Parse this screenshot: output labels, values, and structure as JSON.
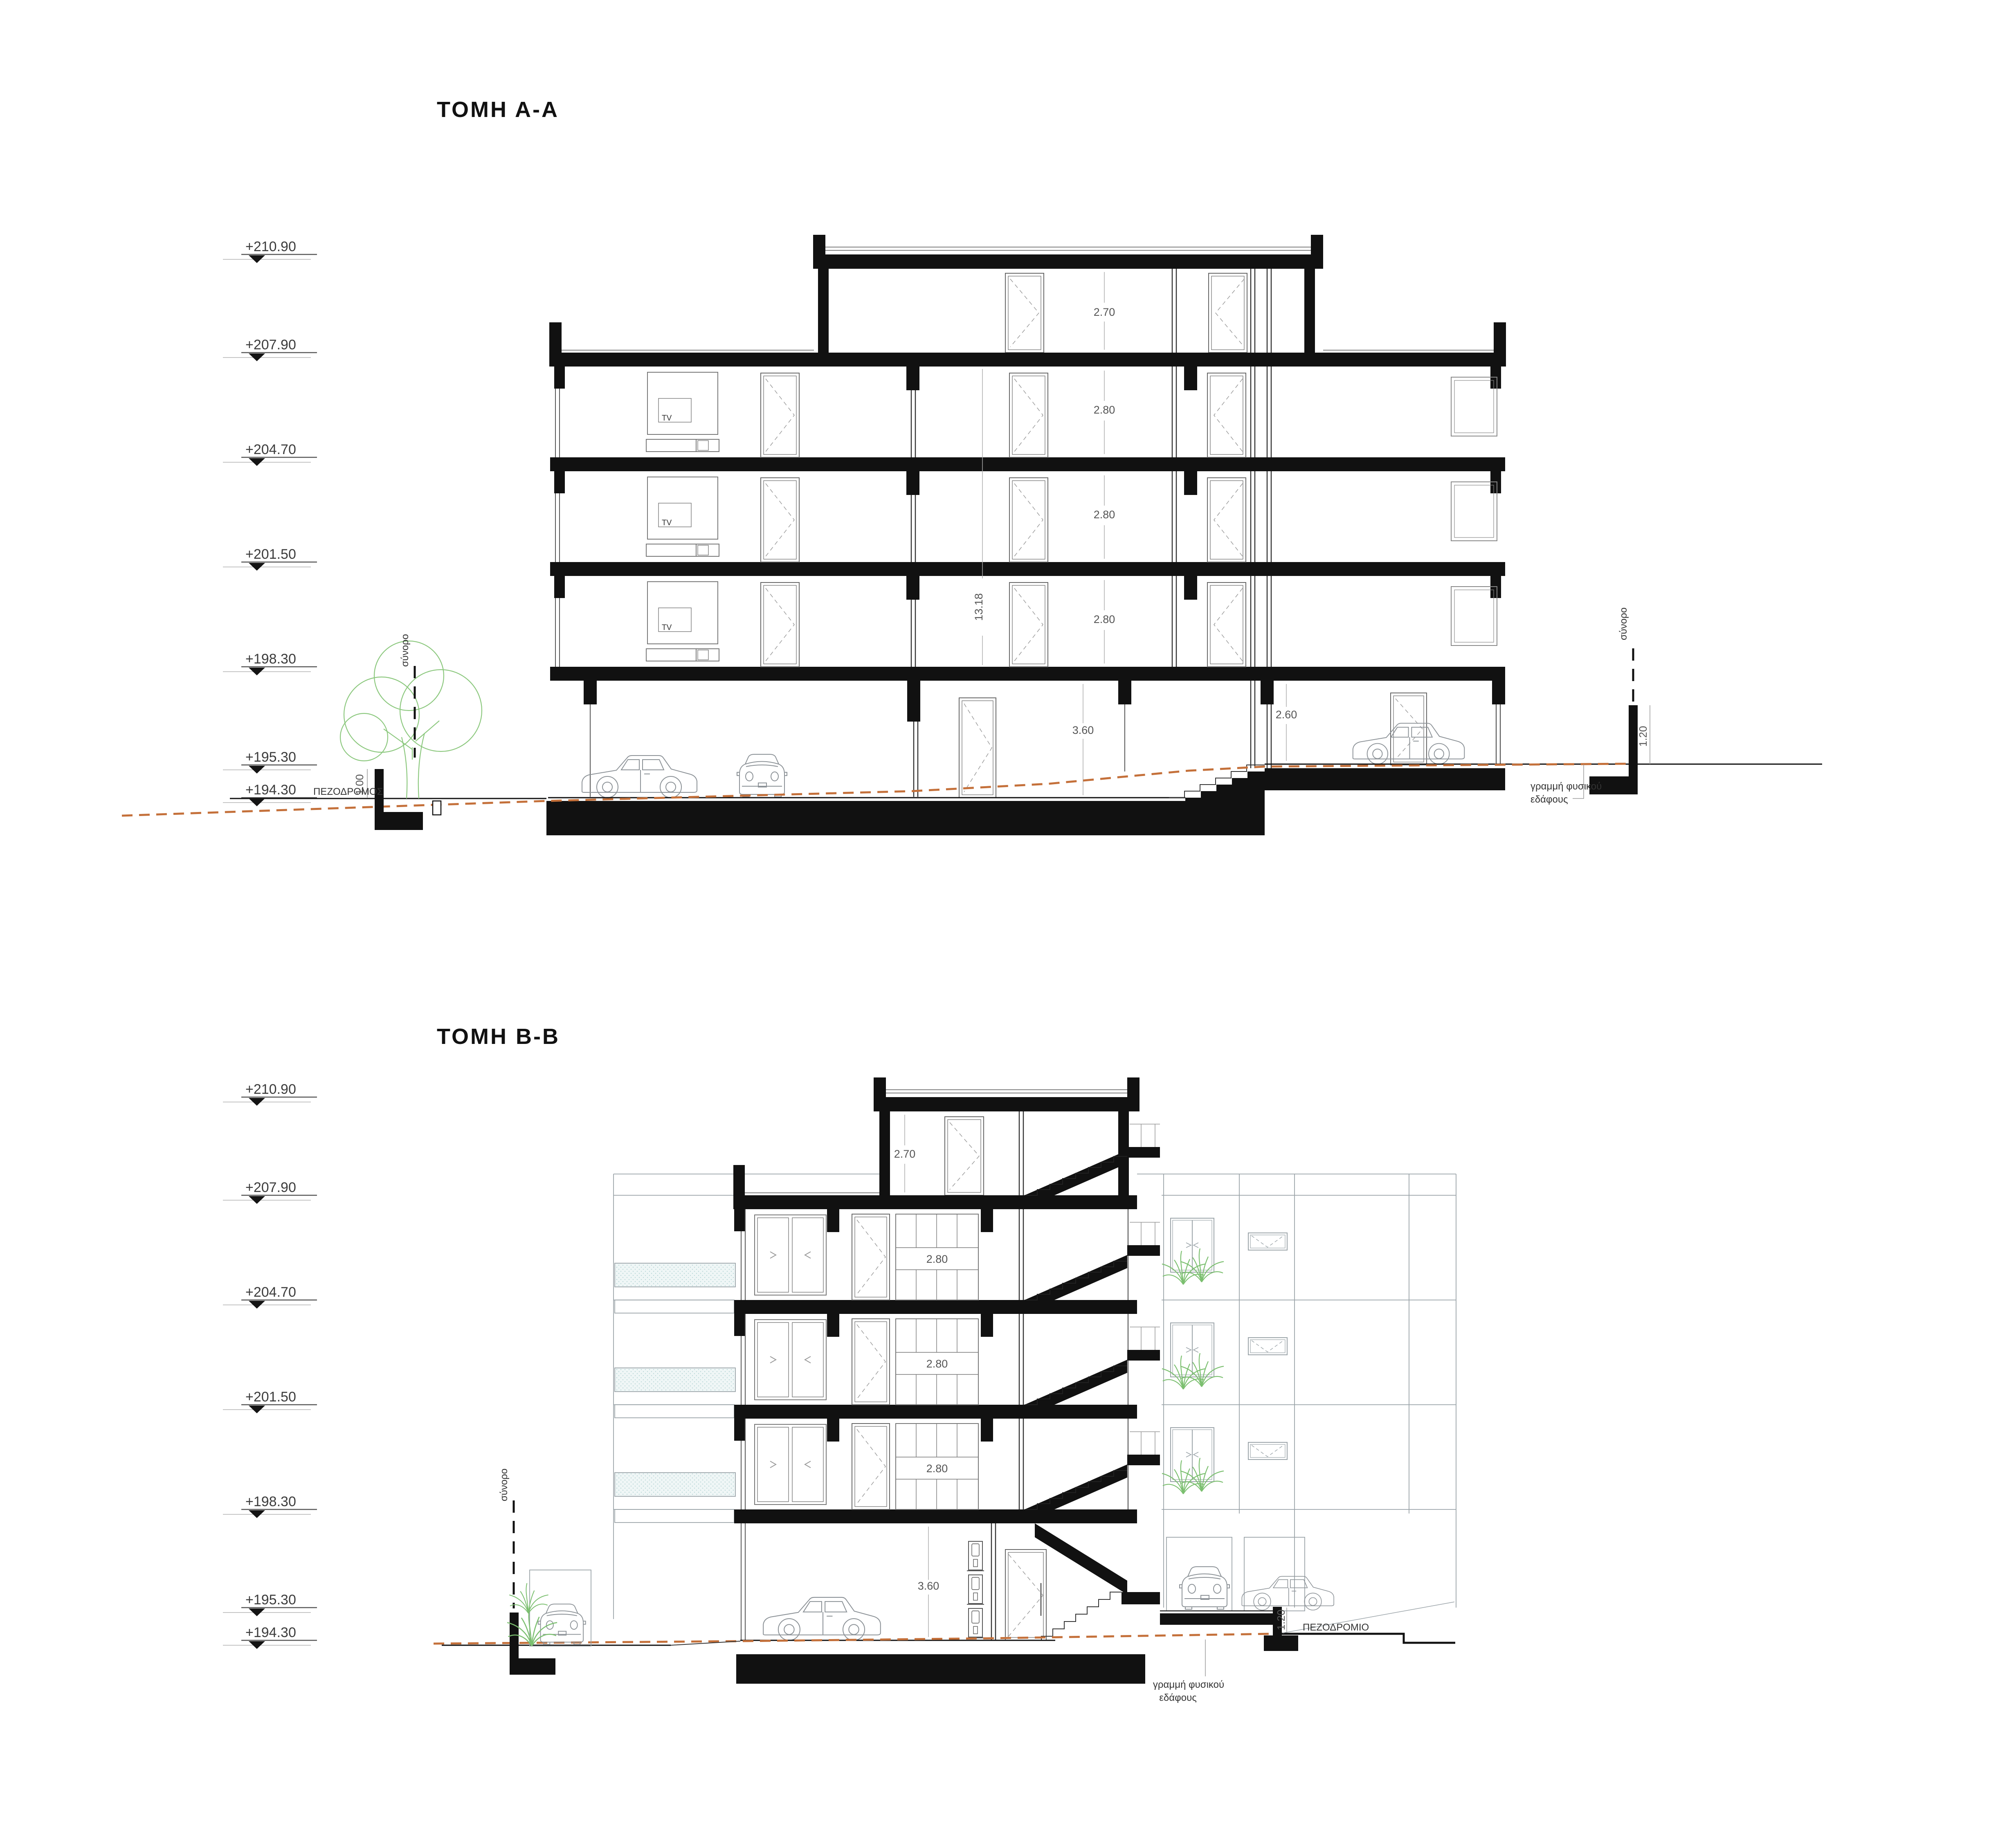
{
  "colors": {
    "ink": "#111111",
    "cut_fill": "#111111",
    "light_line": "#9aa3a8",
    "ground_line": "#c4703a",
    "plant_green": "#7bbf6f",
    "tree_green": "#8cc87e",
    "glass_fill": "#eff6f6",
    "glass_dot": "#b9d7d7"
  },
  "section_aa": {
    "title": "ΤΟΜΗ  Α-Α",
    "levels": [
      "+210.90",
      "+207.90",
      "+204.70",
      "+201.50",
      "+198.30",
      "+195.30",
      "+194.30"
    ],
    "dims": {
      "penthouse": "2.70",
      "floors": [
        "2.80",
        "2.80",
        "2.80"
      ],
      "total": "13.18",
      "garage_left": "3.60",
      "garage_right": "2.60",
      "wall_left": "1.00",
      "wall_right": "1.20"
    },
    "labels": {
      "tv": "TV",
      "sidewalk": "ΠΕΖΟΔΡΟΜΟΣ",
      "boundary": "σύνορο",
      "ground_line_1": "γραμμή φυσικού",
      "ground_line_2": "εδάφους"
    }
  },
  "section_bb": {
    "title": "ΤΟΜΗ  Β-Β",
    "levels": [
      "+210.90",
      "+207.90",
      "+204.70",
      "+201.50",
      "+198.30",
      "+195.30",
      "+194.30"
    ],
    "dims": {
      "penthouse": "2.70",
      "floors": [
        "2.80",
        "2.80",
        "2.80"
      ],
      "garage": "3.60",
      "wall_right": "1.20"
    },
    "labels": {
      "sidewalk": "ΠΕΖΟΔΡΟΜΙΟ",
      "boundary": "σύνορο",
      "ground_line_1": "γραμμή φυσικού",
      "ground_line_2": "εδάφους"
    }
  }
}
